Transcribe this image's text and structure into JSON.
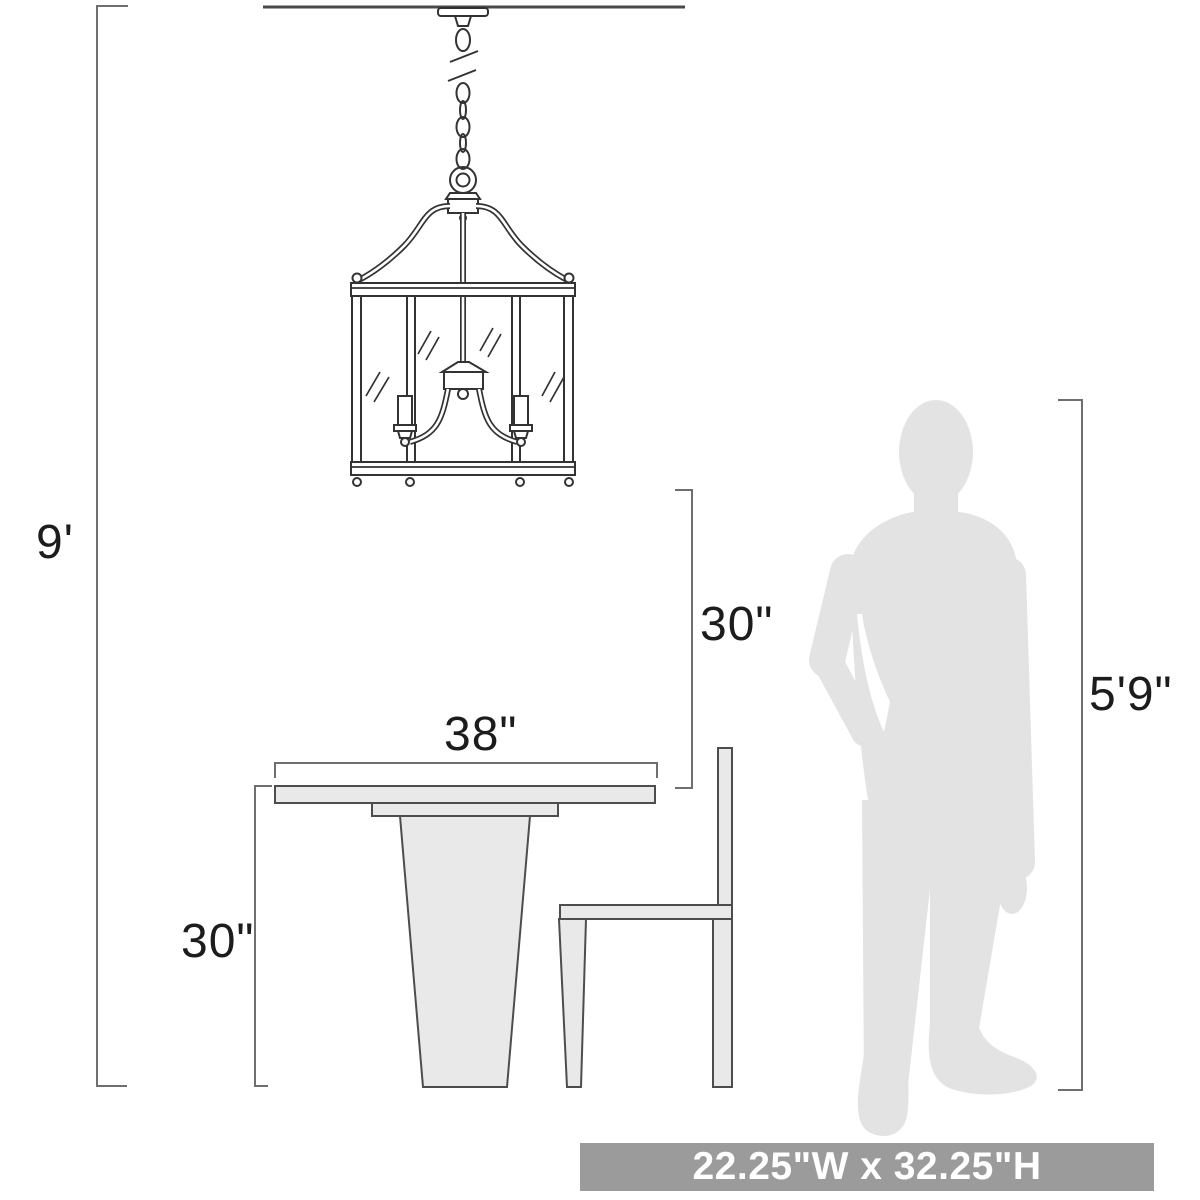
{
  "diagram": {
    "kind": "pendant-light scale diagram",
    "objects": [
      "chandelier",
      "dining-table",
      "chair",
      "person-silhouette"
    ]
  },
  "dimensions": {
    "ceiling_height": "9'",
    "clearance_to_table": "30\"",
    "table_width": "38\"",
    "table_height": "30\"",
    "person_height": "5'9\""
  },
  "banner": {
    "fixture_size": "22.25\"W x 32.25\"H"
  },
  "colors": {
    "background": "#ffffff",
    "drawing_line": "#333333",
    "furniture_line": "#4d4d4d",
    "dimension_line": "#6f6f6f",
    "furniture_fill": "#e9e9e9",
    "silhouette_fill": "#e3e3e3",
    "banner_background": "#9b9b9b",
    "banner_text": "#ffffff",
    "label_text": "#1c1c1c"
  }
}
